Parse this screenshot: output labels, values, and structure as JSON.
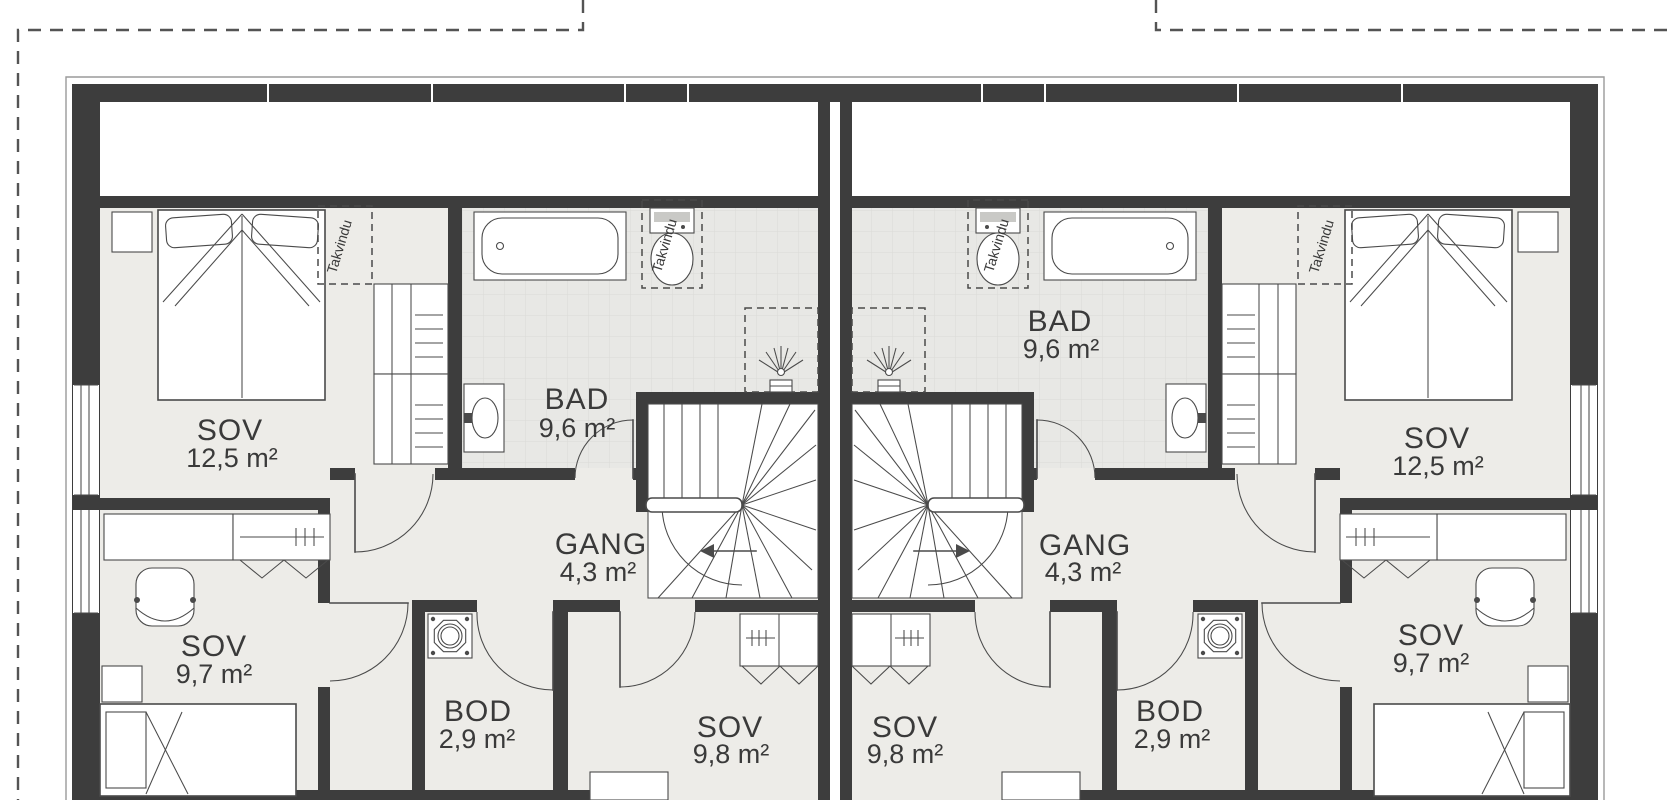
{
  "plan": {
    "units": [
      {
        "side": "left",
        "rooms": {
          "master": {
            "name": "SOV",
            "area": "12,5 m²"
          },
          "bath": {
            "name": "BAD",
            "area": "9,6 m²"
          },
          "hall": {
            "name": "GANG",
            "area": "4,3 m²"
          },
          "bed2": {
            "name": "SOV",
            "area": "9,7 m²"
          },
          "storage": {
            "name": "BOD",
            "area": "2,9 m²"
          },
          "bed3": {
            "name": "SOV",
            "area": "9,8 m²"
          }
        }
      },
      {
        "side": "right",
        "rooms": {
          "master": {
            "name": "SOV",
            "area": "12,5 m²"
          },
          "bath": {
            "name": "BAD",
            "area": "9,6 m²"
          },
          "hall": {
            "name": "GANG",
            "area": "4,3 m²"
          },
          "bed2": {
            "name": "SOV",
            "area": "9,7 m²"
          },
          "storage": {
            "name": "BOD",
            "area": "2,9 m²"
          },
          "bed3": {
            "name": "SOV",
            "area": "9,8 m²"
          }
        }
      }
    ],
    "annotations": {
      "roof_window": "Takvindu"
    },
    "colors": {
      "bg": "#ffffff",
      "wall": "#3d3d3d",
      "floor": "#edece8",
      "tile": "#e8e8e5",
      "tile_line": "#dadad6",
      "line": "#4a4a4a",
      "outline": "#9a9a9a",
      "text": "#3a3a3a"
    }
  }
}
